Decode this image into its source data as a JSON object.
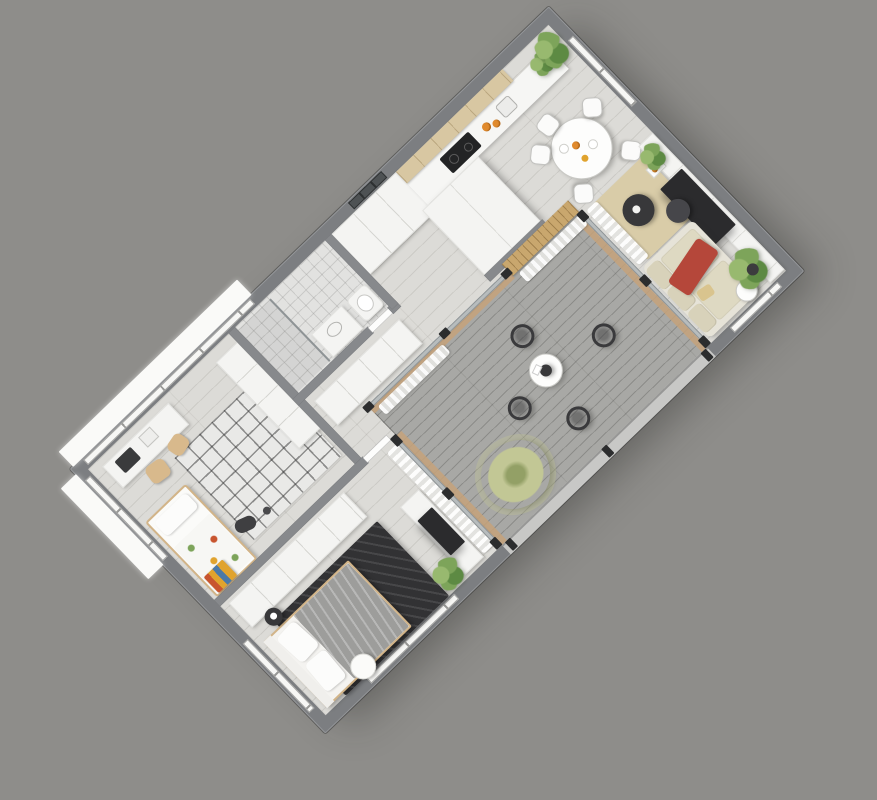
{
  "scene": {
    "type": "3d-floorplan-render",
    "view": "axonometric-top-down",
    "rotation_deg": -44,
    "style": "photorealistic white/grey apartment render, no text labels"
  },
  "colors": {
    "background": "#8e8d8a",
    "wallOuter": "#7c7e81",
    "wallInner": "#87898c",
    "floor": "#dcdbd7",
    "deck": "#a8a8a5",
    "tileFloor": "#e2e2e0",
    "window": "#f7f7f5",
    "ledge": "#fafaf8",
    "glass": "#b7bcbd",
    "post": "#2c2d2e",
    "woodSlat": "#c9a76e",
    "woodTrim": "#c5a27a",
    "curtain": "#ffffff",
    "cabinetTan": "#d8c7a2",
    "counter": "#f6f6f4",
    "cooktop": "#232425",
    "tableWhite": "#fdfdfc",
    "chairWhite": "#fbfbfa",
    "chairDark": "#3a3a3c",
    "sofa": "#e6e3d8",
    "cushion": "#d8d2ba",
    "throwRed": "#b5473a",
    "rugBeige": "#d9cca8",
    "rugDark": "#323234",
    "kidsRug": "#e9e9e7",
    "duvet": "#9d9d9b",
    "bedFrame": "#d2b488",
    "tv": "#2b2b2d",
    "wardrobeWhite": "#f4f4f2",
    "plantA": "#7da45a",
    "plantB": "#5d8a43",
    "plantC": "#98b96f",
    "grassA": "#c2c795",
    "grassB": "#93a066"
  },
  "rooms": [
    {
      "id": "kitchen-dining",
      "name": "Kitchen and dining area",
      "furniture": [
        "tan upper cabinets",
        "white counter with cooktop and sink",
        "fruit bowls",
        "tall white cabinet block",
        "round dining table with food",
        "5 white chairs",
        "potted plants",
        "window"
      ]
    },
    {
      "id": "living-room",
      "name": "Living room",
      "furniture": [
        "white media wall",
        "flat TV",
        "beige sofa with red throw",
        "two dark round coffee tables",
        "beige rug",
        "white curtains",
        "potted plants",
        "side table"
      ]
    },
    {
      "id": "terrace",
      "name": "Terrace deck",
      "furniture": [
        "grey wood decking",
        "4 dark wire chairs",
        "round white table",
        "ornamental grass plant",
        "wood slat wall",
        "glass walls",
        "open railing edge"
      ]
    },
    {
      "id": "hallway",
      "name": "Entrance hallway",
      "furniture": [
        "entry wardrobe",
        "low hall cabinet",
        "dark glazed entrance door"
      ]
    },
    {
      "id": "bathroom",
      "name": "Bathroom",
      "furniture": [
        "walk-in shower with glass panel",
        "vanity with basin",
        "toilet"
      ]
    },
    {
      "id": "kids-room",
      "name": "Kids room / study",
      "furniture": [
        "desk with laptop",
        "two wooden chairs",
        "grid pattern rug",
        "single bed with colorful blanket",
        "white closet",
        "toys"
      ]
    },
    {
      "id": "master-bedroom",
      "name": "Master bedroom",
      "furniture": [
        "wardrobe",
        "double bed with grey duvet",
        "dark patterned rug",
        "white TV console",
        "dark side table",
        "white pouf",
        "potted plant",
        "curtains"
      ]
    }
  ],
  "counts": {
    "terrace_wire_chairs": 4,
    "dining_chairs": 5,
    "terrace_tables": 1,
    "plants_visible": 8
  }
}
